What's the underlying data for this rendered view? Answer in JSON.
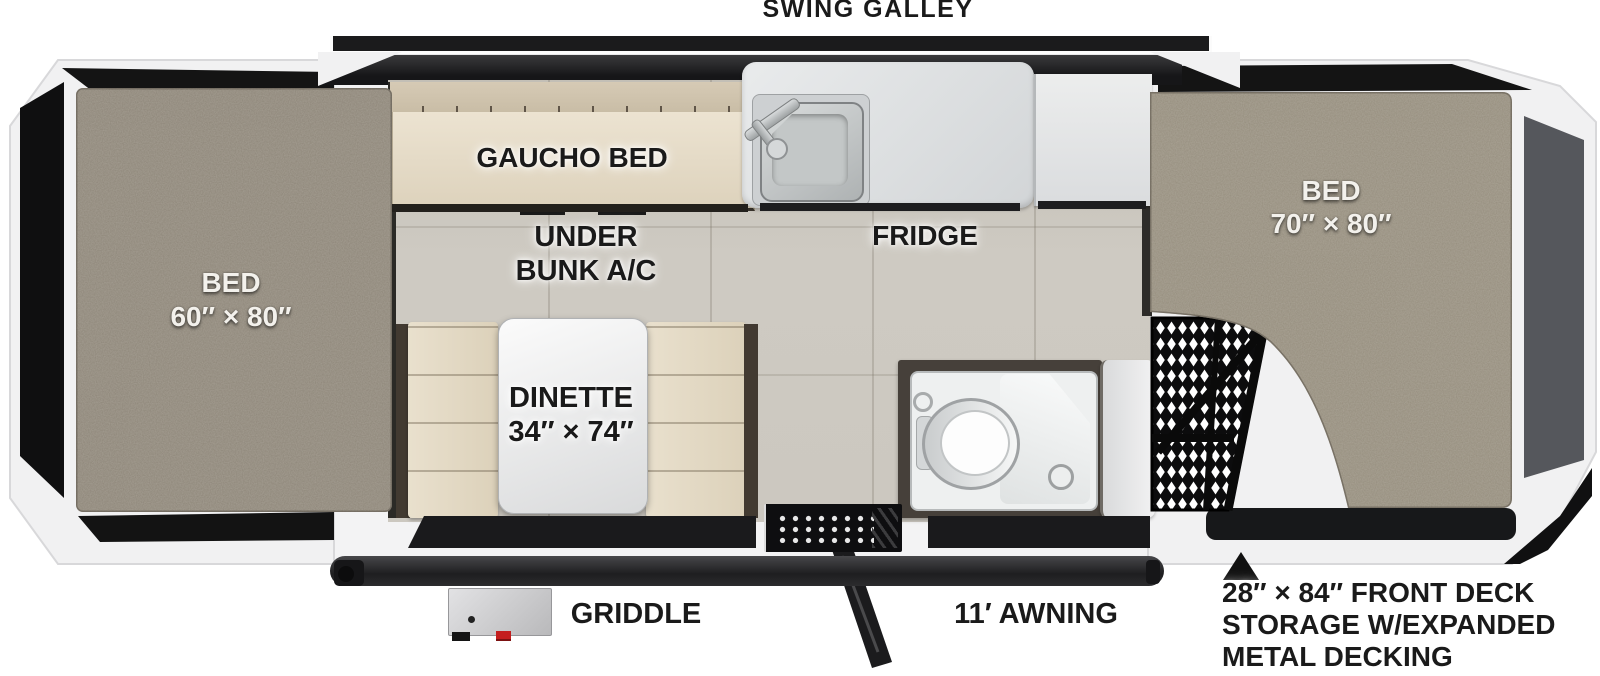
{
  "title": "SWING GALLEY",
  "labels": {
    "rear_bed": {
      "line1": "BED",
      "line2": "60″ × 80″"
    },
    "front_bed": {
      "line1": "BED",
      "line2": "70″ × 80″"
    },
    "gaucho_bed": "GAUCHO BED",
    "under_bunk_ac": {
      "line1": "UNDER",
      "line2": "BUNK A/C"
    },
    "fridge": "FRIDGE",
    "dinette": {
      "line1": "DINETTE",
      "line2": "34″ × 74″"
    },
    "griddle": "GRIDDLE",
    "awning": "11′ AWNING",
    "front_deck_note": {
      "line1": "28″ × 84″ FRONT DECK",
      "line2": "STORAGE W/EXPANDED",
      "line3": "METAL DECKING"
    }
  },
  "icons": {
    "front_deck_pointer": "up-triangle",
    "sink": "kitchen-sink-with-faucet",
    "toilet": "cassette-toilet",
    "mesh": "expanded-metal-decking"
  },
  "colors": {
    "carpet": "#8d8578",
    "carpet_front": "#958d7d",
    "cushion_tan": "#e7decb",
    "cushion_back": "#cfc3ad",
    "counter_gray": "#dfe1e3",
    "floor_tile": "#cac6be",
    "frame_black": "#141415",
    "shower_frame_brown": "#46403a",
    "panel_gray": "#55575c",
    "awning_bar": "#29292b",
    "griddle_red": "#c41e1e"
  }
}
